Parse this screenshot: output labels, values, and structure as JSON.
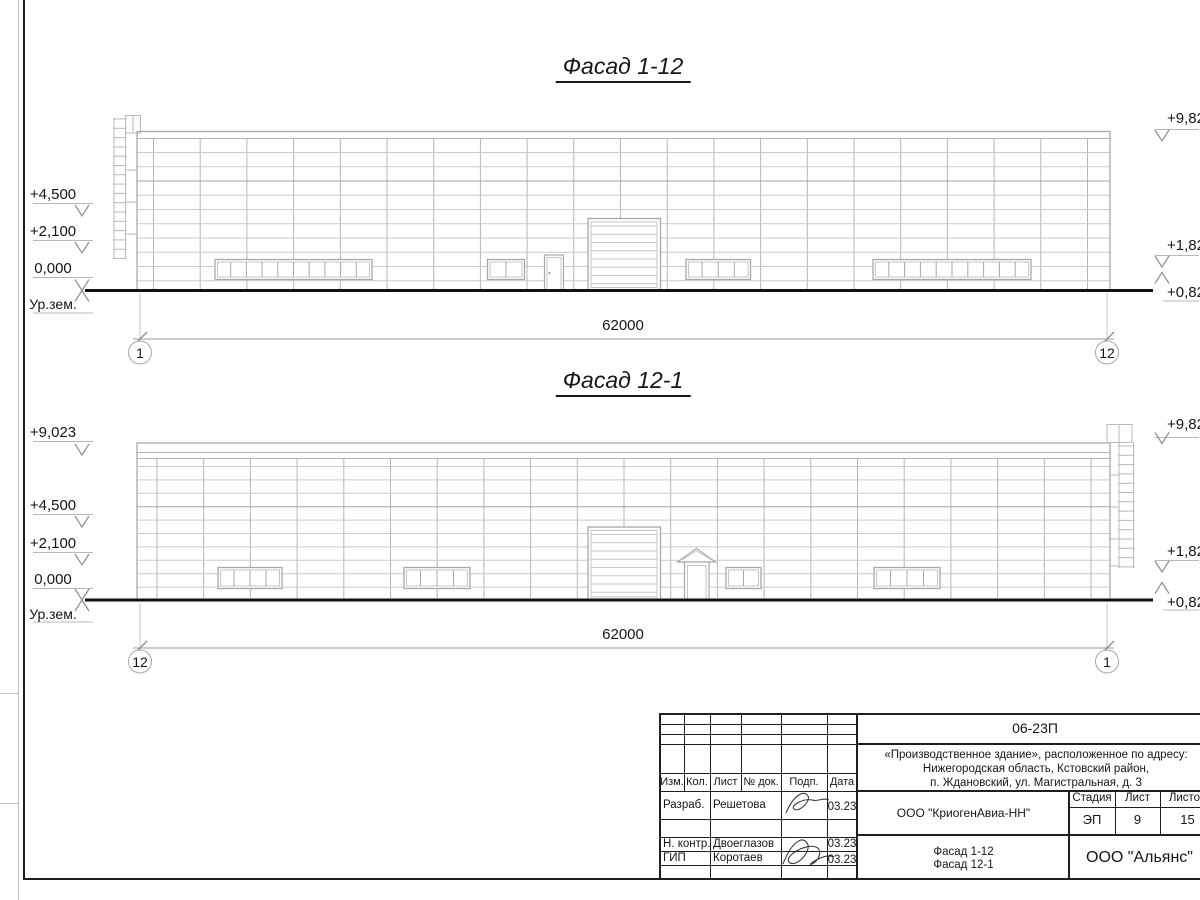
{
  "facade1": {
    "title": "Фасад 1-12",
    "dim": "62000",
    "axis_left": "1",
    "axis_right": "12",
    "elev_left": {
      "e1": "+4,500",
      "e2": "+2,100",
      "e3": "0,000",
      "e4": "Ур.зем."
    },
    "elev_right": {
      "e1": "+9,82",
      "e2": "+1,82",
      "e3": "+0,82"
    }
  },
  "facade2": {
    "title": "Фасад 12-1",
    "dim": "62000",
    "axis_left": "12",
    "axis_right": "1",
    "elev_left": {
      "e0": "+9,023",
      "e1": "+4,500",
      "e2": "+2,100",
      "e3": "0,000",
      "e4": "Ур.зем."
    },
    "elev_right": {
      "e1": "+9,82",
      "e2": "+1,82",
      "e3": "+0,82"
    }
  },
  "titleblock": {
    "doc_number": "06-23П",
    "project_line1": "«Производственное здание», расположенное по адресу:",
    "project_line2": "Нижегородская область, Кстовский район,",
    "project_line3": "п. Ждановский, ул. Магистральная, д. 3",
    "col_izm": "Изм.",
    "col_kol": "Кол.",
    "col_list": "Лист",
    "col_ndok": "№ док.",
    "col_podp": "Подп.",
    "col_data": "Дата",
    "rows": [
      {
        "role": "Разраб.",
        "name": "Решетова",
        "date": "03.23"
      },
      {
        "role": "Н. контр.",
        "name": "Двоеглазов",
        "date": "03.23"
      },
      {
        "role": "ГИП",
        "name": "Коротаев",
        "date": "03.23"
      }
    ],
    "org": "ООО \"КриогенАвиа-НН\"",
    "stage_label": "Стадия",
    "stage_value": "ЭП",
    "sheet_label": "Лист",
    "sheet_value": "9",
    "sheets_label": "Листов",
    "sheets_value": "15",
    "drawing_line1": "Фасад 1-12",
    "drawing_line2": "Фасад 12-1",
    "contractor": "ООО \"Альянс\""
  }
}
